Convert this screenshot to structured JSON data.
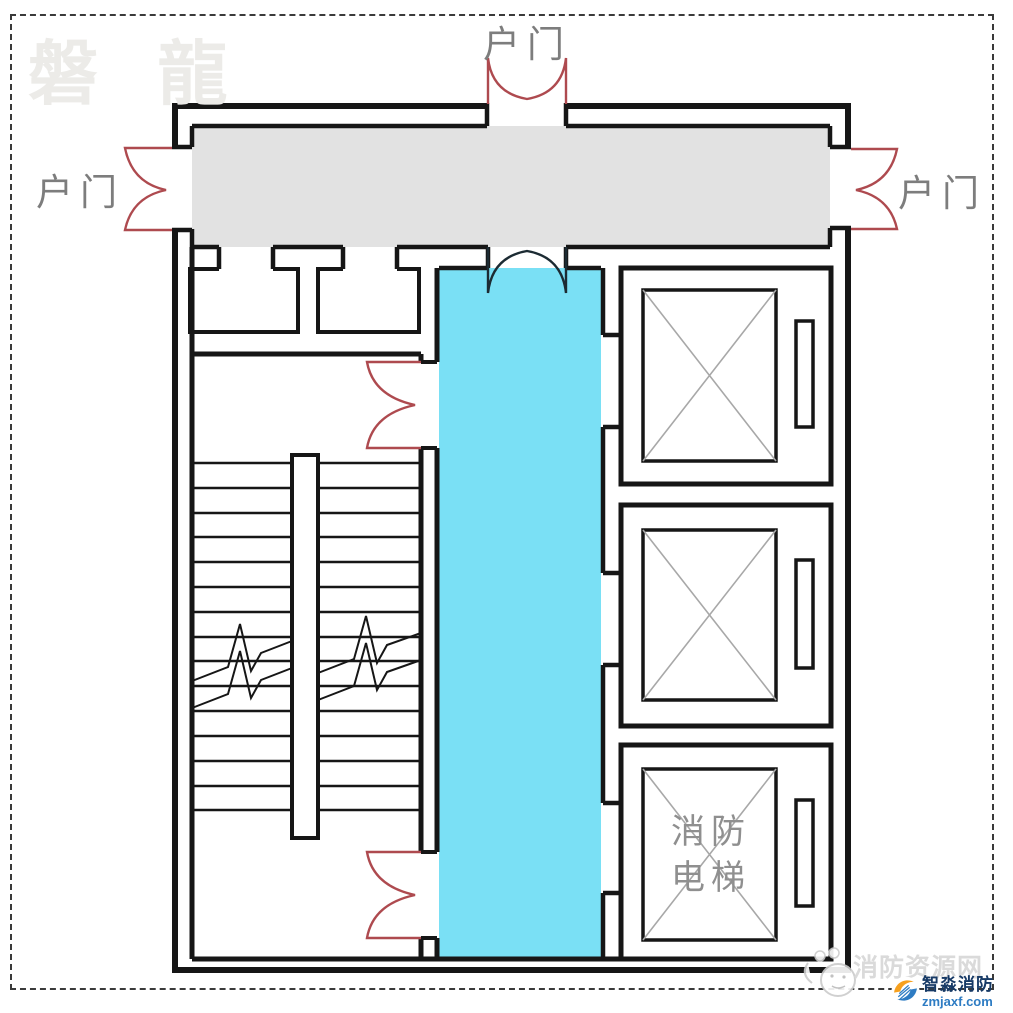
{
  "watermarks": {
    "brand": "磐 龍",
    "site": "消防资源网"
  },
  "labels": {
    "door_top": "户门",
    "door_left": "户门",
    "door_right": "户门",
    "fire_elevator": "消防电梯"
  },
  "logo": {
    "name": "智淼消防",
    "domain": "zmjaxf.com"
  },
  "colors": {
    "wall_black": "#161616",
    "door_red": "#ae4a4f",
    "front_room_fill": "#7ae0f5",
    "corridor_fill": "#e2e2e2",
    "elevator_x_gray": "#a8a8a8",
    "label_gray": "#7d7d7d",
    "fire_elevator_gray": "#8f8f8f",
    "watermark_gray": "#d9d9d9",
    "logo_navy": "#173a66",
    "logo_blue": "#2e7cc3",
    "logo_orange": "#f6a01e"
  }
}
